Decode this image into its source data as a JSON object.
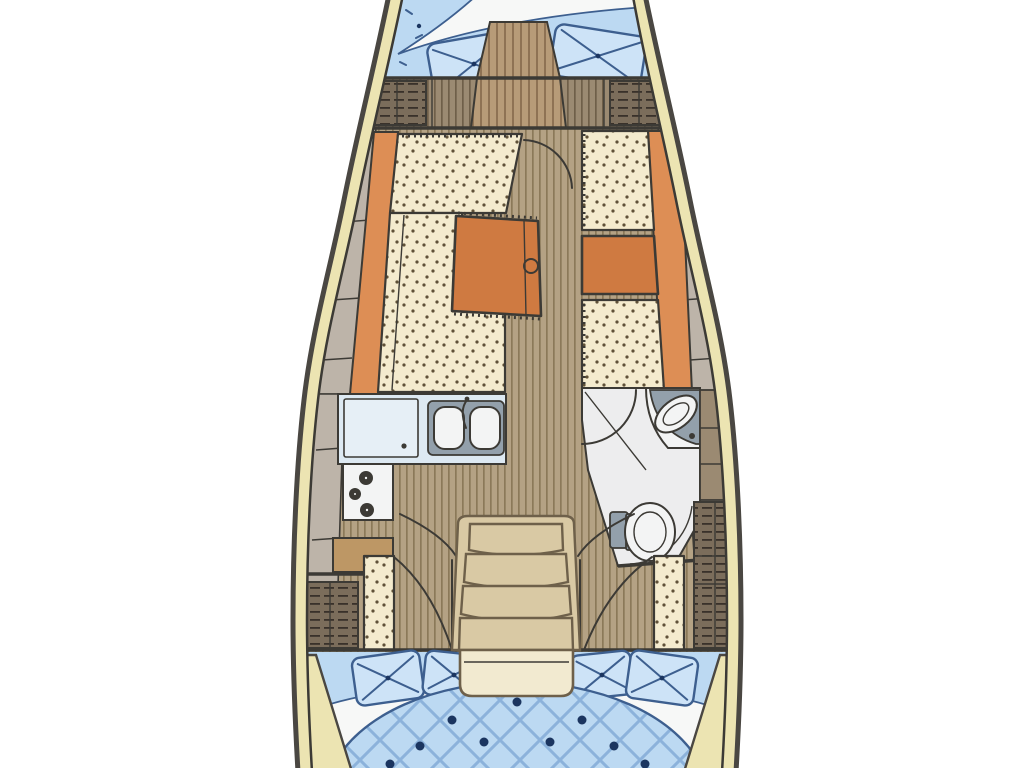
{
  "diagram": {
    "type": "boat-floor-plan",
    "orientation": "bow-top",
    "regions": [
      {
        "id": "v-berth",
        "name": "forward-v-berth"
      },
      {
        "id": "forward-lockers",
        "name": "forward-bulkhead-lockers"
      },
      {
        "id": "salon-port",
        "name": "port-l-settee-with-table"
      },
      {
        "id": "salon-starboard",
        "name": "starboard-settee"
      },
      {
        "id": "galley",
        "name": "galley-sink-stove"
      },
      {
        "id": "head",
        "name": "head-toilet-basin"
      },
      {
        "id": "companionway",
        "name": "companionway-steps"
      },
      {
        "id": "aft-cabin",
        "name": "aft-double-berth"
      }
    ],
    "palette": {
      "background": "#ffffff",
      "hullOutline": "#4a4742",
      "outline": "#3c3a35",
      "deckBand": "#ece4b2",
      "sideLocker": "#bdb4a9",
      "woodFloor": "#b4a284",
      "woodStripe": "#8b7959",
      "bulkheadWood": "#9b8a72",
      "bulkheadStripe": "#6f5f49",
      "bowWood": "#b79b78",
      "bowStripe": "#8e7254",
      "cushionCream": "#f4ebce",
      "cushionDot": "#5f5138",
      "accentOrange": "#dd8e55",
      "accentOrangeDark": "#cf7a41",
      "berthBlue": "#bcd9f2",
      "pillowBlue": "#cde3f7",
      "berthLine": "#3d5f8f",
      "berthQuilt": "#7fa9d6",
      "berthNavy": "#1b3560",
      "sheetWhite": "#f7f8f7",
      "counterBlue": "#dde9f2",
      "counterLight": "#e6eff6",
      "sinkGray": "#93a0ab",
      "fixtureWhite": "#f3f4f4",
      "headFloor": "#ededee",
      "lockerDark": "#7b6d5b",
      "lockerHatch": "#39312a",
      "stepBeige": "#d9c9a4",
      "stepLine": "#6e604a",
      "landing": "#f2ead0",
      "cabinetTan": "#bd9765"
    }
  }
}
